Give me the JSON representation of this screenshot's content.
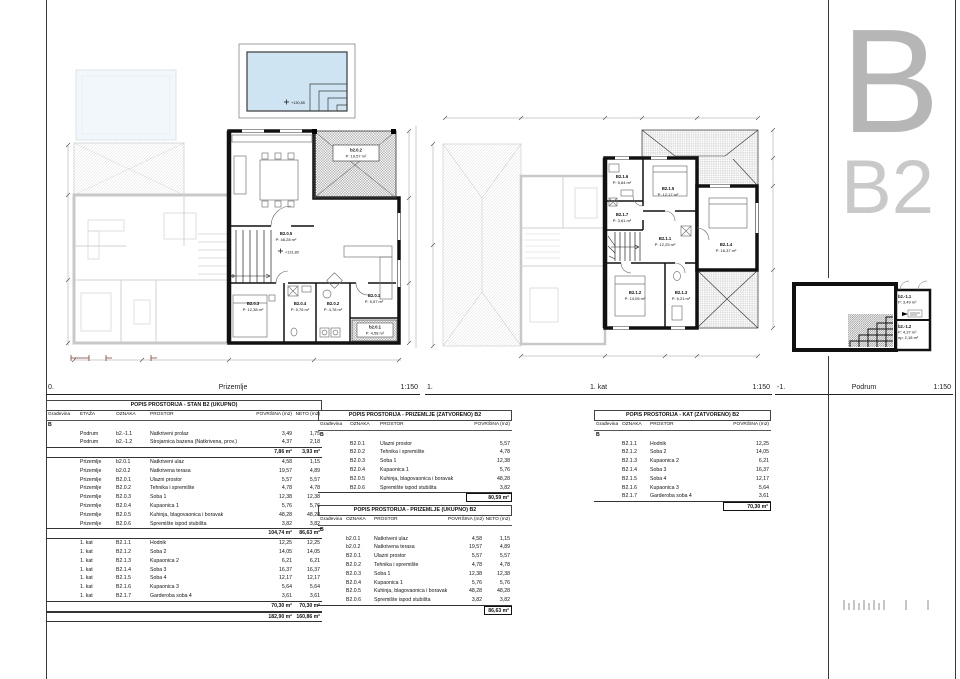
{
  "sheet": {
    "letter": "B",
    "code": "B2"
  },
  "colors": {
    "wall": "#111111",
    "faded": "#c8c8c8",
    "pool_fill": "#cfe4f2",
    "rule": "#3a3a3a",
    "letter_gray": "#b6b6b6"
  },
  "plan_labels": [
    {
      "num": "0.",
      "name": "Prizemlje",
      "scale": "1:150"
    },
    {
      "num": "1.",
      "name": "1. kat",
      "scale": "1:150"
    },
    {
      "num": "-1.",
      "name": "Podrum",
      "scale": "1:150"
    }
  ],
  "plans": {
    "prizemlje": {
      "level": "+131,80",
      "pool_level": "+130,85",
      "rooms": [
        {
          "id": "B2.0.5",
          "area": "P: 48,28 m²"
        },
        {
          "id": "B2.0.3",
          "area": "P: 12,38 m²"
        },
        {
          "id": "B2.0.4",
          "area": "P: 5,76 m²"
        },
        {
          "id": "B2.0.2",
          "area": "P: 4,78 m²"
        },
        {
          "id": "B2.0.1",
          "area": "P: 5,57 m²"
        },
        {
          "id": "b2.0.1",
          "area": "P: 4,58 m²"
        },
        {
          "id": "b2.0.2",
          "area": "P: 19,57 m²"
        }
      ]
    },
    "kat": {
      "rooms": [
        {
          "id": "B2.1.6",
          "area": "P: 5,64 m²"
        },
        {
          "id": "B2.1.5",
          "area": "P: 12,17 m²"
        },
        {
          "id": "B2.1.7",
          "area": "P: 3,61 m²"
        },
        {
          "id": "B2.1.1",
          "area": "P: 12,25 m²"
        },
        {
          "id": "B2.1.4",
          "area": "P: 16,37 m²"
        },
        {
          "id": "B2.1.2",
          "area": "P: 14,05 m²"
        },
        {
          "id": "B2.1.3",
          "area": "P: 6,21 m²"
        }
      ]
    },
    "podrum": {
      "rooms": [
        {
          "id": "b2.-1.1",
          "area": "P: 3,49 m²",
          "extra": ""
        },
        {
          "id": "b2.-1.2",
          "area": "P: 4,37 m²",
          "extra": "np: 2,18 m²"
        }
      ]
    }
  },
  "tables": {
    "t1": {
      "title": "POPIS PROSTORIJA - STAN B2 (UKUPNO)",
      "headers": {
        "g": "Građevina",
        "e": "ETAŽA",
        "o": "OZNAKA",
        "p": "PROSTOR",
        "a": "POVRŠINA (m2)",
        "n": "NETO (m2)"
      },
      "rows": [
        {
          "g": "B",
          "cls": "group"
        },
        {
          "e": "Podrum",
          "o": "b2.-1.1",
          "p": "Natkriveni prolaz",
          "a": "3,49",
          "n": "1,75"
        },
        {
          "e": "Podrum",
          "o": "b2.-1.2",
          "p": "Strojarnica bazena (Natkrivena, prov.)",
          "a": "4,37",
          "n": "2,18"
        },
        {
          "a": "7,86 m²",
          "n": "3,93 m²",
          "cls": "subtotal"
        },
        {
          "e": "Prizemlje",
          "o": "b2.0.1",
          "p": "Natkriveni ulaz",
          "a": "4,58",
          "n": "1,15"
        },
        {
          "e": "Prizemlje",
          "o": "b2.0.2",
          "p": "Natkrivena terasa",
          "a": "19,57",
          "n": "4,89"
        },
        {
          "e": "Prizemlje",
          "o": "B2.0.1",
          "p": "Ulazni prostor",
          "a": "5,57",
          "n": "5,57"
        },
        {
          "e": "Prizemlje",
          "o": "B2.0.2",
          "p": "Tehnika i spremište",
          "a": "4,78",
          "n": "4,78"
        },
        {
          "e": "Prizemlje",
          "o": "B2.0.3",
          "p": "Soba 1",
          "a": "12,38",
          "n": "12,38"
        },
        {
          "e": "Prizemlje",
          "o": "B2.0.4",
          "p": "Kupaonica 1",
          "a": "5,76",
          "n": "5,76"
        },
        {
          "e": "Prizemlje",
          "o": "B2.0.5",
          "p": "Kuhinja, blagovaonica i boravak",
          "a": "48,28",
          "n": "48,28"
        },
        {
          "e": "Prizemlje",
          "o": "B2.0.6",
          "p": "Spremište ispod stubišta",
          "a": "3,82",
          "n": "3,82"
        },
        {
          "a": "104,74 m²",
          "n": "86,63 m²",
          "cls": "subtotal"
        },
        {
          "e": "1. kat",
          "o": "B2.1.1",
          "p": "Hodnik",
          "a": "12,25",
          "n": "12,25"
        },
        {
          "e": "1. kat",
          "o": "B2.1.2",
          "p": "Soba 2",
          "a": "14,05",
          "n": "14,05"
        },
        {
          "e": "1. kat",
          "o": "B2.1.3",
          "p": "Kupaonica 2",
          "a": "6,21",
          "n": "6,21"
        },
        {
          "e": "1. kat",
          "o": "B2.1.4",
          "p": "Soba 3",
          "a": "16,37",
          "n": "16,37"
        },
        {
          "e": "1. kat",
          "o": "B2.1.5",
          "p": "Soba 4",
          "a": "12,17",
          "n": "12,17"
        },
        {
          "e": "1. kat",
          "o": "B2.1.6",
          "p": "Kupaonica 3",
          "a": "5,64",
          "n": "5,64"
        },
        {
          "e": "1. kat",
          "o": "B2.1.7",
          "p": "Garderoba soba 4",
          "a": "3,61",
          "n": "3,61"
        },
        {
          "a": "70,30 m²",
          "n": "70,30 m²",
          "cls": "subtotal"
        },
        {
          "a": "182,90 m²",
          "n": "160,86 m²",
          "cls": "grand"
        }
      ]
    },
    "t2a": {
      "title": "POPIS PROSTORIJA - PRIZEMLJE  (ZATVORENO)  B2",
      "headers": {
        "g": "Građevina",
        "o": "OZNAKA",
        "p": "PROSTOR",
        "a": "POVRŠINA (m2)"
      },
      "rows": [
        {
          "g": "B",
          "cls": "group"
        },
        {
          "o": "B2.0.1",
          "p": "Ulazni prostor",
          "a": "5,57"
        },
        {
          "o": "B2.0.2",
          "p": "Tehnika i spremište",
          "a": "4,78"
        },
        {
          "o": "B2.0.3",
          "p": "Soba 1",
          "a": "12,38"
        },
        {
          "o": "B2.0.4",
          "p": "Kupaonica 1",
          "a": "5,76"
        },
        {
          "o": "B2.0.5",
          "p": "Kuhinja, blagovaonica i boravak",
          "a": "48,28"
        },
        {
          "o": "B2.0.6",
          "p": "Spremište ispod stubišta",
          "a": "3,82"
        },
        {
          "a": "80,59 m²",
          "cls": "boxed"
        }
      ]
    },
    "t2b": {
      "title": "POPIS PROSTORIJA - PRIZEMLJE  (UKUPNO)  B2",
      "headers": {
        "g": "Građevina",
        "o": "OZNAKA",
        "p": "PROSTOR",
        "a": "POVRŠINA (m2)",
        "n": "NETO (m2)"
      },
      "rows": [
        {
          "g": "B",
          "cls": "group"
        },
        {
          "o": "b2.0.1",
          "p": "Natkriveni ulaz",
          "a": "4,58",
          "n": "1,15"
        },
        {
          "o": "b2.0.2",
          "p": "Natkrivena terasa",
          "a": "19,57",
          "n": "4,89"
        },
        {
          "o": "B2.0.1",
          "p": "Ulazni prostor",
          "a": "5,57",
          "n": "5,57"
        },
        {
          "o": "B2.0.2",
          "p": "Tehnika i spremište",
          "a": "4,78",
          "n": "4,78"
        },
        {
          "o": "B2.0.3",
          "p": "Soba 1",
          "a": "12,38",
          "n": "12,38"
        },
        {
          "o": "B2.0.4",
          "p": "Kupaonica 1",
          "a": "5,76",
          "n": "5,76"
        },
        {
          "o": "B2.0.5",
          "p": "Kuhinja, blagovaonica i boravak",
          "a": "48,28",
          "n": "48,28"
        },
        {
          "o": "B2.0.6",
          "p": "Spremište ispod stubišta",
          "a": "3,82",
          "n": "3,82"
        },
        {
          "n": "86,63 m²",
          "cls": "boxed"
        }
      ]
    },
    "t3": {
      "title": "POPIS PROSTORIJA - KAT  (ZATVORENO)  B2",
      "headers": {
        "g": "Građevina",
        "o": "OZNAKA",
        "p": "PROSTOR",
        "a": "POVRŠINA (m2)"
      },
      "rows": [
        {
          "g": "B",
          "cls": "group"
        },
        {
          "o": "B2.1.1",
          "p": "Hodnik",
          "a": "12,25"
        },
        {
          "o": "B2.1.2",
          "p": "Soba 2",
          "a": "14,05"
        },
        {
          "o": "B2.1.3",
          "p": "Kupaonica 2",
          "a": "6,21"
        },
        {
          "o": "B2.1.4",
          "p": "Soba 3",
          "a": "16,37"
        },
        {
          "o": "B2.1.5",
          "p": "Soba 4",
          "a": "12,17"
        },
        {
          "o": "B2.1.6",
          "p": "Kupaonica 3",
          "a": "5,64"
        },
        {
          "o": "B2.1.7",
          "p": "Garderoba soba 4",
          "a": "3,61"
        },
        {
          "a": "70,30 m²",
          "cls": "boxed"
        }
      ]
    }
  }
}
